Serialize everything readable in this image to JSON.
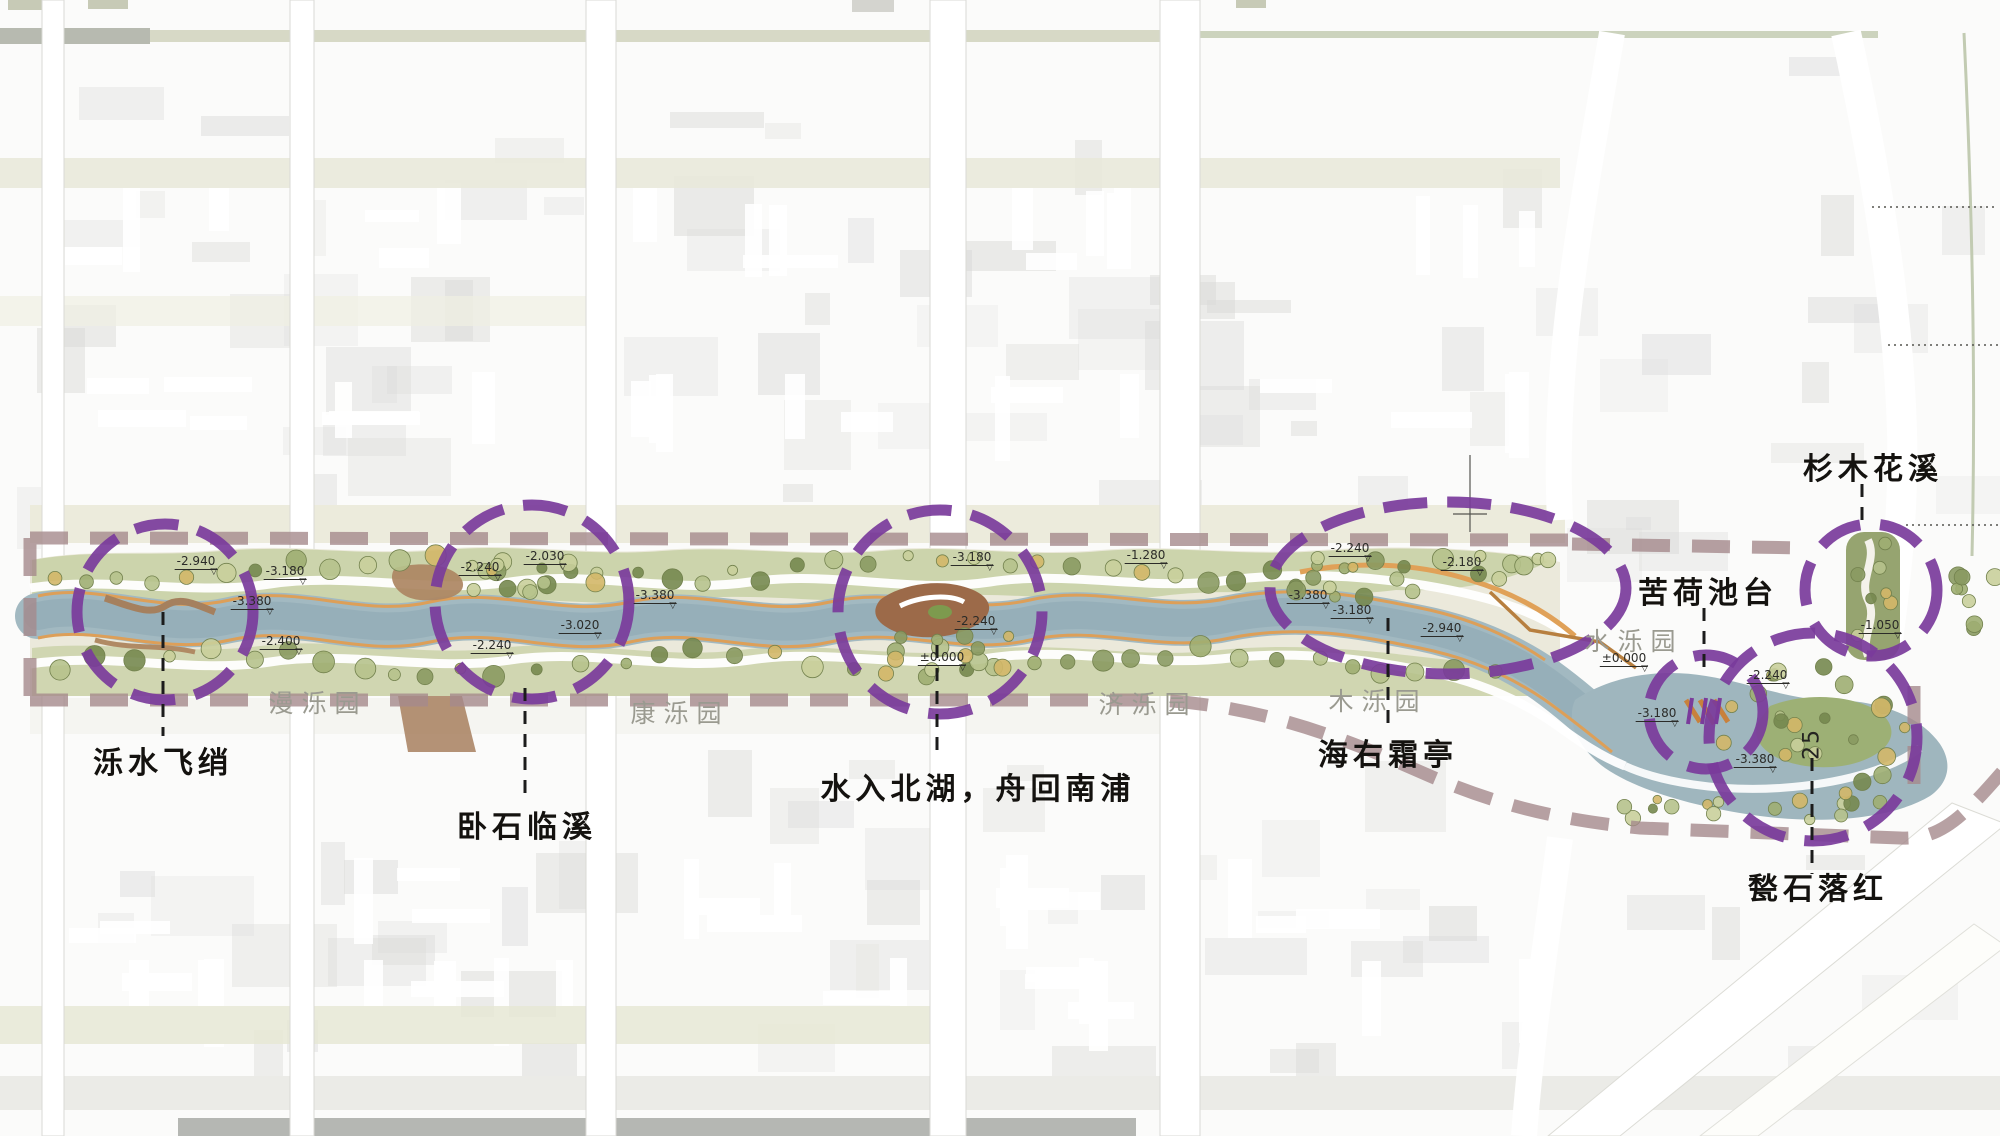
{
  "plan": {
    "type": "landscape-corridor-masterplan",
    "colors": {
      "accent_purple": "#7a3b9b",
      "boundary_mauve": "#a58a8c",
      "water": "#a2b9c1",
      "water_deep": "#93adb7",
      "bank_green": "#c5cfa1",
      "path_orange": "#dd9f58",
      "park_label_grey": "#9a9a90",
      "ink": "#1c1c1c"
    },
    "nodes": [
      {
        "id": "luoshui-feixiao",
        "label": "泺水飞绡",
        "cx": 165,
        "cy": 612,
        "rx": 88,
        "ry": 88,
        "leader": [
          163,
          612,
          163,
          736
        ],
        "label_x": 163,
        "label_y": 760
      },
      {
        "id": "woshi-linxi",
        "label": "卧石临溪",
        "cx": 532,
        "cy": 602,
        "rx": 97,
        "ry": 97,
        "leader": [
          525,
          688,
          525,
          802
        ],
        "label_x": 527,
        "label_y": 824
      },
      {
        "id": "shuiru-beihu",
        "label": "水入北湖，舟回南浦",
        "cx": 940,
        "cy": 612,
        "rx": 102,
        "ry": 102,
        "leader": [
          937,
          645,
          937,
          758
        ],
        "label_x": 978,
        "label_y": 786
      },
      {
        "id": "haiyou-shuangting",
        "label": "海右霜亭",
        "cx": 1448,
        "cy": 588,
        "rx": 178,
        "ry": 86,
        "leader": [
          1388,
          618,
          1388,
          730
        ],
        "label_x": 1388,
        "label_y": 752
      },
      {
        "id": "kuhe-chitai",
        "label": "苦荷池台",
        "cx": 1706,
        "cy": 712,
        "rx": 57,
        "ry": 57,
        "leader": [
          1704,
          608,
          1704,
          668
        ],
        "label_x": 1708,
        "label_y": 590
      },
      {
        "id": "zhoushi-luohong",
        "label": "甃石落红",
        "cx": 1813,
        "cy": 737,
        "rx": 104,
        "ry": 104,
        "leader": [
          1812,
          758,
          1812,
          874
        ],
        "label_x": 1818,
        "label_y": 886
      },
      {
        "id": "shanmu-huaxi",
        "label": "杉木花溪",
        "cx": 1871,
        "cy": 590,
        "rx": 66,
        "ry": 66,
        "leader": [
          1862,
          484,
          1862,
          522
        ],
        "label_x": 1873,
        "label_y": 466
      }
    ],
    "parks": [
      {
        "id": "man-luo-yuan",
        "label": "漫泺园",
        "x": 318,
        "y": 702
      },
      {
        "id": "kang-luo-yuan",
        "label": "康泺园",
        "x": 680,
        "y": 712
      },
      {
        "id": "ji-luo-yuan",
        "label": "济泺园",
        "x": 1148,
        "y": 703
      },
      {
        "id": "mu-luo-yuan",
        "label": "木泺园",
        "x": 1378,
        "y": 700
      },
      {
        "id": "shui-luo-yuan",
        "label": "水泺园",
        "x": 1634,
        "y": 640
      }
    ],
    "elevations": [
      {
        "text": "-2.940",
        "x": 196,
        "y": 566
      },
      {
        "text": "-3.180",
        "x": 285,
        "y": 576
      },
      {
        "text": "-3.380",
        "x": 252,
        "y": 606
      },
      {
        "text": "-2.400",
        "x": 281,
        "y": 646
      },
      {
        "text": "-2.240",
        "x": 480,
        "y": 572
      },
      {
        "text": "-2.030",
        "x": 545,
        "y": 561
      },
      {
        "text": "-3.380",
        "x": 655,
        "y": 600
      },
      {
        "text": "-3.020",
        "x": 580,
        "y": 630
      },
      {
        "text": "-2.240",
        "x": 492,
        "y": 650
      },
      {
        "text": "-3.180",
        "x": 972,
        "y": 562
      },
      {
        "text": "-2.240",
        "x": 976,
        "y": 626
      },
      {
        "text": "±0.000",
        "x": 942,
        "y": 662
      },
      {
        "text": "-1.280",
        "x": 1146,
        "y": 560
      },
      {
        "text": "-2.240",
        "x": 1350,
        "y": 553
      },
      {
        "text": "-2.180",
        "x": 1462,
        "y": 567
      },
      {
        "text": "-3.380",
        "x": 1308,
        "y": 600
      },
      {
        "text": "-3.180",
        "x": 1352,
        "y": 615
      },
      {
        "text": "-2.940",
        "x": 1442,
        "y": 633
      },
      {
        "text": "±0.000",
        "x": 1624,
        "y": 663
      },
      {
        "text": "-3.180",
        "x": 1657,
        "y": 718
      },
      {
        "text": "-2.240",
        "x": 1768,
        "y": 680
      },
      {
        "text": "-3.380",
        "x": 1755,
        "y": 764
      },
      {
        "text": "-1.050",
        "x": 1880,
        "y": 630
      }
    ],
    "road_station": {
      "text": "25",
      "x": 1812,
      "y": 744
    }
  }
}
